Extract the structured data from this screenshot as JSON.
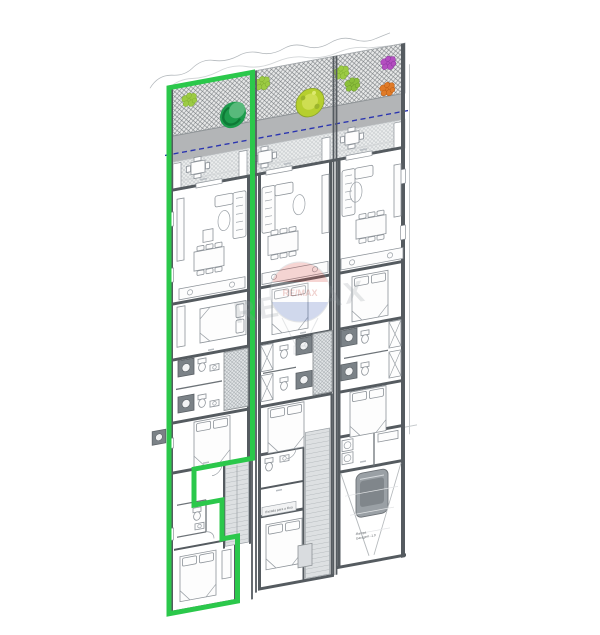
{
  "plan": {
    "kind": "architectural floor plan, three row-house units, left unit highlighted",
    "units": [
      {
        "id": "left",
        "highlighted": true
      },
      {
        "id": "middle",
        "highlighted": false
      },
      {
        "id": "right",
        "highlighted": false
      }
    ],
    "garden": {
      "plant_icons": [
        "bush-light-green",
        "tree-dark-green",
        "bush-light-green",
        "tree-yellow-green",
        "bush-light-green",
        "bush-light-green",
        "bush-purple",
        "bush-orange"
      ]
    }
  },
  "labels": {
    "stair_to_street": "Escada para a Rua",
    "ramp_line1": "Rampa",
    "ramp_line2": "Garagem -1.0"
  },
  "watermark": {
    "text": "RE/MAX",
    "balloon_text": "RE/MAX"
  },
  "colors": {
    "highlight": "#2bc84b",
    "wall": "#555b60",
    "blue_dash": "#2b35b0",
    "garden_gray": "#b3b5b7",
    "bush_light": "#9ccb44",
    "bush_light2": "#8bbf3a",
    "tree_dark": "#1d9c4c",
    "tree_dark_inner": "#58b97b",
    "tree_yellow": "#b6cf2e",
    "tree_yellow_inner": "#cede52",
    "bush_orange": "#e07b28",
    "bush_purple": "#b44fc0",
    "balloon_red": "#d9453c",
    "balloon_blue": "#3558b5"
  }
}
